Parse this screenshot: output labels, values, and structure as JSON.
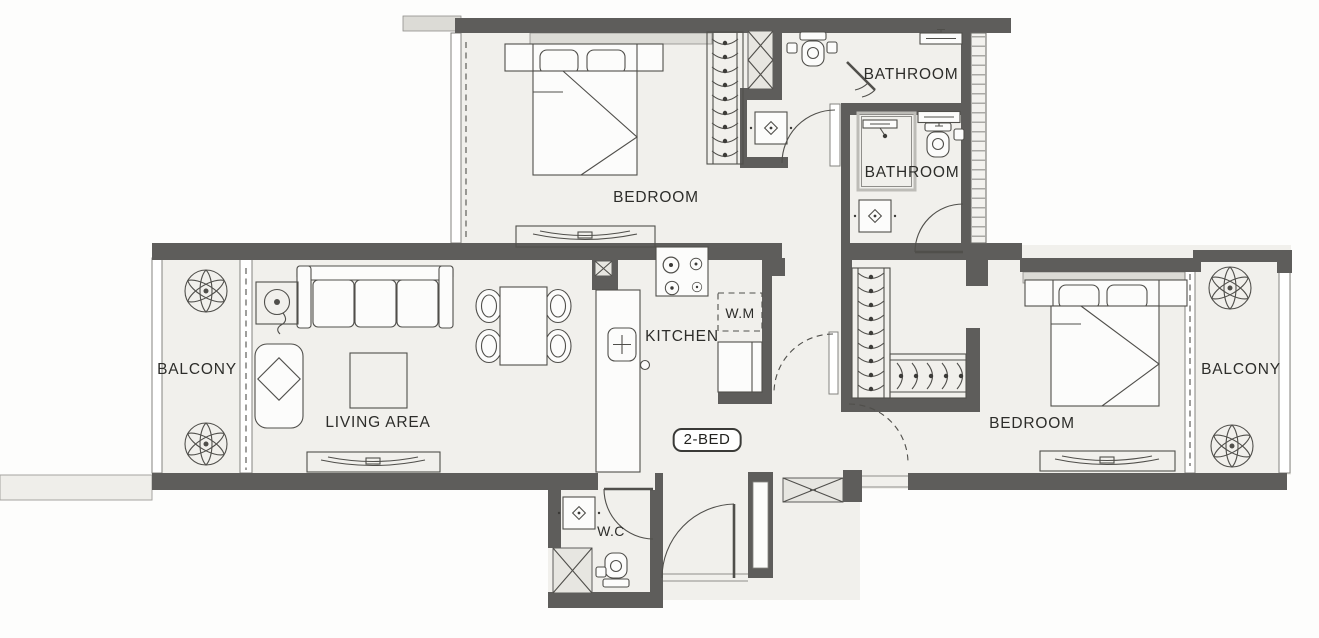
{
  "title": "2-bed apartment floor plan",
  "unit": {
    "badge": "2-BED"
  },
  "rooms": {
    "bedroom_top": {
      "label": "BEDROOM"
    },
    "bathroom_upper": {
      "label": "BATHROOM"
    },
    "bathroom_lower": {
      "label": "BATHROOM"
    },
    "balcony_left": {
      "label": "BALCONY"
    },
    "living_area": {
      "label": "LIVING AREA"
    },
    "kitchen": {
      "label": "KITCHEN"
    },
    "washer": {
      "label": "W.M"
    },
    "wc": {
      "label": "W.C"
    },
    "bedroom_right": {
      "label": "BEDROOM"
    },
    "balcony_right": {
      "label": "BALCONY"
    }
  },
  "colors": {
    "wall": "#5e5d5b",
    "floor": "#f1f0ec",
    "window_band": "#dcdbd6",
    "outline": "#504f4b",
    "text": "#2d2d2a",
    "background": "#fdfdfc"
  }
}
